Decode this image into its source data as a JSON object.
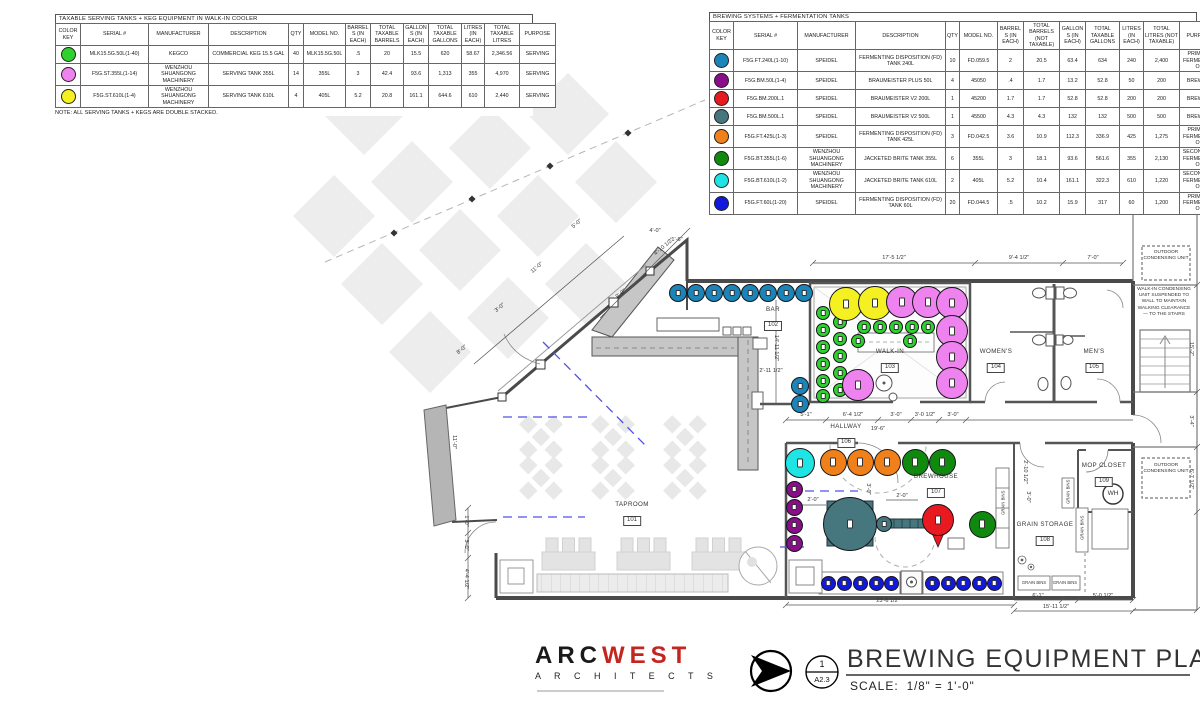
{
  "tables": [
    {
      "title": "TAXABLE SERVING TANKS + KEG EQUIPMENT IN WALK-IN COOLER",
      "headers": [
        "COLOR KEY",
        "SERIAL #",
        "MANUFACTURER",
        "DESCRIPTION",
        "QTY",
        "MODEL NO.",
        "BARRELS (IN EACH)",
        "TOTAL TAXABLE BARRELS",
        "GALLONS (IN EACH)",
        "TOTAL TAXABLE GALLONS",
        "LITRES (IN EACH)",
        "TOTAL TAXABLE LITRES",
        "PURPOSE"
      ],
      "widths": [
        25,
        68,
        60,
        80,
        15,
        42,
        25,
        33,
        25,
        33,
        23,
        35,
        36
      ],
      "rows": [
        {
          "color": "#2fd12f",
          "cells": [
            "MLK15.5G.50L(1-40)",
            "KEGCO",
            "COMMERCIAL KEG 15.5 GAL",
            "40",
            "MLK15.5G.50L",
            ".5",
            "20",
            "15.5",
            "620",
            "58.67",
            "2,346.56",
            "SERVING"
          ]
        },
        {
          "color": "#ee82ee",
          "cells": [
            "F5G.ST.355L(1-14)",
            "WENZHOU SHUANGONG MACHINERY",
            "SERVING TANK 355L",
            "14",
            "355L",
            "3",
            "42.4",
            "93.6",
            "1,313",
            "355",
            "4,970",
            "SERVING"
          ]
        },
        {
          "color": "#f5f022",
          "cells": [
            "F5G.ST.610L(1-4)",
            "WENZHOU SHUANGONG MACHINERY",
            "SERVING TANK 610L",
            "4",
            "405L",
            "5.2",
            "20.8",
            "161.1",
            "644.6",
            "610",
            "2,440",
            "SERVING"
          ]
        }
      ],
      "note": "NOTE: ALL SERVING TANKS + KEGS ARE DOUBLE STACKED."
    },
    {
      "title": "BREWING SYSTEMS + FERMENTATION TANKS",
      "headers": [
        "COLOR KEY",
        "SERIAL #",
        "MANUFACTURER",
        "DESCRIPTION",
        "QTY",
        "MODEL NO.",
        "BARRELS (IN EACH)",
        "TOTAL BARRELS (NOT TAXABLE)",
        "GALLONS (IN EACH)",
        "TOTAL TAXABLE GALLONS",
        "LITRES (IN EACH)",
        "TOTAL LITRES (NOT TAXABLE)",
        "PURPOSE"
      ],
      "widths": [
        24,
        64,
        58,
        90,
        14,
        38,
        26,
        36,
        26,
        34,
        24,
        36,
        40
      ],
      "rows": [
        {
          "color": "#1b84b8",
          "cells": [
            "F5G.FT.240L(1-10)",
            "SPEIDEL",
            "FERMENTING DISPOSITION (FD) TANK 240L",
            "10",
            "FD.059.5",
            "2",
            "20.5",
            "63.4",
            "634",
            "240",
            "2,400",
            "PRIMARY FERMENTATION"
          ]
        },
        {
          "color": "#8a0d8a",
          "cells": [
            "F5G.BM.50L(1-4)",
            "SPEIDEL",
            "BRAUMEISTER PLUS 50L",
            "4",
            "45050",
            ".4",
            "1.7",
            "13.2",
            "52.8",
            "50",
            "200",
            "BREWING"
          ]
        },
        {
          "color": "#e8191f",
          "cells": [
            "F5G.BM.200L.1",
            "SPEIDEL",
            "BRAUMEISTER V2 200L",
            "1",
            "45200",
            "1.7",
            "1.7",
            "52.8",
            "52.8",
            "200",
            "200",
            "BREWING"
          ]
        },
        {
          "color": "#46777e",
          "cells": [
            "F5G.BM.500L.1",
            "SPEIDEL",
            "BRAUMEISTER V2 500L",
            "1",
            "45500",
            "4.3",
            "4.3",
            "132",
            "132",
            "500",
            "500",
            "BREWING"
          ]
        },
        {
          "color": "#f08019",
          "cells": [
            "F5G.FT.425L(1-3)",
            "SPEIDEL",
            "FERMENTING DISPOSITION (FD) TANK 425L",
            "3",
            "FD.042.5",
            "3.6",
            "10.9",
            "112.3",
            "336.9",
            "425",
            "1,275",
            "PRIMARY FERMENTATION"
          ]
        },
        {
          "color": "#0f8a0f",
          "cells": [
            "F5G.BT.355L(1-6)",
            "WENZHOU SHUANGONG MACHINERY",
            "JACKETED BRITE TANK 355L",
            "6",
            "355L",
            "3",
            "18.1",
            "93.6",
            "561.6",
            "355",
            "2,130",
            "SECONDARY FERMENTATION"
          ]
        },
        {
          "color": "#1fe4e4",
          "cells": [
            "F5G.BT.610L(1-2)",
            "WENZHOU SHUANGONG MACHINERY",
            "JACKETED BRITE TANK 610L",
            "2",
            "405L",
            "5.2",
            "10.4",
            "161.1",
            "322.3",
            "610",
            "1,220",
            "SECONDARY FERMENTATION"
          ]
        },
        {
          "color": "#1318dd",
          "cells": [
            "F5G.FT.60L(1-20)",
            "SPEIDEL",
            "FERMENTING DISPOSITION (FD) TANK 60L",
            "20",
            "FD.044.5",
            ".5",
            "10.2",
            "15.9",
            "317",
            "60",
            "1,200",
            "PRIMARY FERMENTATION"
          ]
        }
      ]
    }
  ],
  "plan": {
    "rooms": [
      {
        "name": "TAPROOM",
        "num": "101",
        "x": 632,
        "y": 501
      },
      {
        "name": "BAR",
        "num": "102",
        "x": 773,
        "y": 306
      },
      {
        "name": "WALK-IN",
        "num": "103",
        "x": 890,
        "y": 348
      },
      {
        "name": "WOMEN'S",
        "num": "104",
        "x": 996,
        "y": 348
      },
      {
        "name": "MEN'S",
        "num": "105",
        "x": 1094,
        "y": 348
      },
      {
        "name": "HALLWAY",
        "num": "106",
        "x": 846,
        "y": 423
      },
      {
        "name": "BREWHOUSE",
        "num": "107",
        "x": 936,
        "y": 473
      },
      {
        "name": "GRAIN STORAGE",
        "num": "108",
        "x": 1045,
        "y": 521
      },
      {
        "name": "MOP CLOSET",
        "num": "109",
        "x": 1104,
        "y": 462
      }
    ],
    "dimensions": [
      [
        "17'-5 1/2\"",
        894,
        258,
        0
      ],
      [
        "9'-4 1/2\"",
        1019,
        258,
        0
      ],
      [
        "7'-0\"",
        1093,
        258,
        0
      ],
      [
        "5'-1\"",
        806,
        415,
        0
      ],
      [
        "6'-4 1/2\"",
        853,
        415,
        0
      ],
      [
        "3'-0\"",
        896,
        415,
        0
      ],
      [
        "3'-0 1/2\"",
        925,
        415,
        0
      ],
      [
        "3'-0\"",
        953,
        415,
        0
      ],
      [
        "19'-6\"",
        878,
        429,
        0
      ],
      [
        "23'-6 1/2\"",
        888,
        601,
        0
      ],
      [
        "6'-1\"",
        1038,
        596,
        0
      ],
      [
        "5'-0 1/2\"",
        1103,
        596,
        0
      ],
      [
        "15'-11 1/2\"",
        1056,
        607,
        0
      ],
      [
        "2'-0\"",
        813,
        500,
        0
      ],
      [
        "2'-0\"",
        902,
        496,
        0
      ],
      [
        "3'-0\"",
        868,
        489,
        90
      ],
      [
        "14'-11 1/2\"",
        776,
        348,
        90
      ],
      [
        "2'-11 1/2\"",
        771,
        371,
        0
      ],
      [
        "11'-0\"",
        454,
        442,
        90
      ],
      [
        "1'-0\"",
        466,
        521,
        90
      ],
      [
        "3'-0\"",
        466,
        545,
        90
      ],
      [
        "4'-4 1/2\"",
        466,
        579,
        90
      ],
      [
        "15'-2\"",
        1191,
        349,
        90
      ],
      [
        "3'-4\"",
        1191,
        421,
        90
      ],
      [
        "6'-7 1/2\"",
        1191,
        479,
        90
      ],
      [
        "11'-0\"",
        537,
        268,
        -40
      ],
      [
        "3'-0\"",
        500,
        308,
        -40
      ],
      [
        "8'-0\"",
        462,
        350,
        -40
      ],
      [
        "9'-0\"",
        621,
        294,
        -40
      ],
      [
        "4'-10 1/2\"",
        664,
        247,
        -40
      ],
      [
        "5'-0\"",
        577,
        224,
        -40
      ],
      [
        "4'-0\"",
        655,
        231,
        0
      ],
      [
        "1'-6\"",
        677,
        240,
        0
      ],
      [
        "2'-10 1/2\"",
        1025,
        472,
        90
      ],
      [
        "3'-0\"",
        1028,
        497,
        90
      ]
    ],
    "notes": [
      {
        "t": "OUTDOOR CONDENSING UNIT",
        "x": 1166,
        "y": 250,
        "w": 46,
        "fs": 4.8,
        "name": "outdoor-condensing-unit-note-1"
      },
      {
        "t": "OUTDOOR CONDENSING UNIT",
        "x": 1166,
        "y": 463,
        "w": 46,
        "fs": 4.8,
        "name": "outdoor-condensing-unit-note-2"
      },
      {
        "t": "WALK-IN CONDENSING UNIT SUSPENDED TO WALL TO MAINTAIN WALKING CLEARANCE — TO THE STAIRS",
        "x": 1164,
        "y": 287,
        "w": 58,
        "fs": 4.8,
        "name": "condensing-unit-wall-note"
      },
      {
        "t": "GRAIN BINS",
        "x": 1003,
        "y": 500,
        "w": 40,
        "fs": 4.2,
        "rot": -90,
        "name": "grain-bins-label"
      },
      {
        "t": "GRAIN BINS",
        "x": 1068,
        "y": 489,
        "w": 26,
        "fs": 4.2,
        "rot": -90,
        "name": "grain-bins-label"
      },
      {
        "t": "GRAIN BINS",
        "x": 1082,
        "y": 525,
        "w": 36,
        "fs": 4.2,
        "rot": -90,
        "name": "grain-bins-label"
      },
      {
        "t": "GRAIN BINS",
        "x": 1034,
        "y": 580,
        "w": 30,
        "fs": 4.2,
        "name": "grain-bins-label"
      },
      {
        "t": "GRAIN BINS",
        "x": 1065,
        "y": 580,
        "w": 28,
        "fs": 4.2,
        "name": "grain-bins-label"
      },
      {
        "t": "WH",
        "x": 1113,
        "y": 490,
        "w": 20,
        "fs": 6.5,
        "name": "water-heater-label"
      }
    ],
    "tanks": [
      {
        "name": "commercial-keg",
        "color": "#2fd12f",
        "r": 7,
        "pts": [
          [
            823,
            313
          ],
          [
            823,
            330
          ],
          [
            823,
            347
          ],
          [
            823,
            364
          ],
          [
            823,
            381
          ],
          [
            823,
            396
          ],
          [
            840,
            322
          ],
          [
            840,
            339
          ],
          [
            840,
            356
          ],
          [
            840,
            373
          ],
          [
            840,
            390
          ],
          [
            864,
            327
          ],
          [
            880,
            327
          ],
          [
            896,
            327
          ],
          [
            912,
            327
          ],
          [
            928,
            327
          ],
          [
            858,
            341
          ],
          [
            910,
            341
          ]
        ]
      },
      {
        "name": "serving-610",
        "color": "#f5f022",
        "r": 17,
        "pts": [
          [
            846,
            304
          ],
          [
            875,
            303
          ]
        ]
      },
      {
        "name": "serving-355",
        "color": "#ee82ee",
        "r": 16,
        "pts": [
          [
            902,
            302
          ],
          [
            928,
            302
          ],
          [
            952,
            303
          ],
          [
            952,
            331
          ],
          [
            952,
            357
          ],
          [
            952,
            383
          ],
          [
            858,
            385
          ]
        ]
      },
      {
        "name": "fd-240",
        "color": "#1b84b8",
        "r": 9,
        "pts": [
          [
            678,
            293
          ],
          [
            696,
            293
          ],
          [
            714,
            293
          ],
          [
            732,
            293
          ],
          [
            750,
            293
          ],
          [
            768,
            293
          ],
          [
            786,
            293
          ],
          [
            804,
            293
          ],
          [
            800,
            386
          ],
          [
            800,
            404
          ]
        ]
      },
      {
        "name": "fd-60",
        "color": "#1318dd",
        "r": 7.5,
        "pts": [
          [
            828,
            583
          ],
          [
            844,
            583
          ],
          [
            860,
            583
          ],
          [
            876,
            583
          ],
          [
            891,
            583
          ],
          [
            932,
            583
          ],
          [
            948,
            583
          ],
          [
            963,
            583
          ],
          [
            979,
            583
          ],
          [
            994,
            583
          ]
        ]
      },
      {
        "name": "bm-50",
        "color": "#8a0d8a",
        "r": 8.5,
        "pts": [
          [
            794,
            489
          ],
          [
            794,
            507
          ],
          [
            794,
            525
          ],
          [
            794,
            543
          ]
        ]
      },
      {
        "name": "fd-425",
        "color": "#f08019",
        "r": 13.5,
        "pts": [
          [
            833,
            462
          ],
          [
            860,
            462
          ],
          [
            887,
            462
          ]
        ]
      },
      {
        "name": "brite-355",
        "color": "#0f8a0f",
        "r": 13.5,
        "pts": [
          [
            915,
            462
          ],
          [
            942,
            462
          ],
          [
            982,
            524
          ]
        ]
      },
      {
        "name": "brite-610",
        "color": "#1fe4e4",
        "r": 15,
        "pts": [
          [
            800,
            463
          ]
        ]
      },
      {
        "name": "bm-500",
        "color": "#46777e",
        "r": 27,
        "pts": [
          [
            850,
            524
          ]
        ]
      },
      {
        "name": "bm-500-aux",
        "color": "#46777e",
        "r": 8,
        "pts": [
          [
            884,
            524
          ]
        ]
      },
      {
        "name": "bm-200",
        "color": "#e8191f",
        "r": 16,
        "pts": [
          [
            938,
            520
          ]
        ]
      }
    ]
  },
  "titleblock": {
    "logo_primary": "ARC",
    "logo_secondary": "WEST",
    "logo_sub": "A R C H I T E C T S",
    "detail_number": "1",
    "sheet_ref": "A2.3",
    "drawing_title": "BREWING EQUIPMENT PLAN",
    "scale_label": "SCALE:",
    "scale_value": "1/8\" = 1'-0\""
  }
}
